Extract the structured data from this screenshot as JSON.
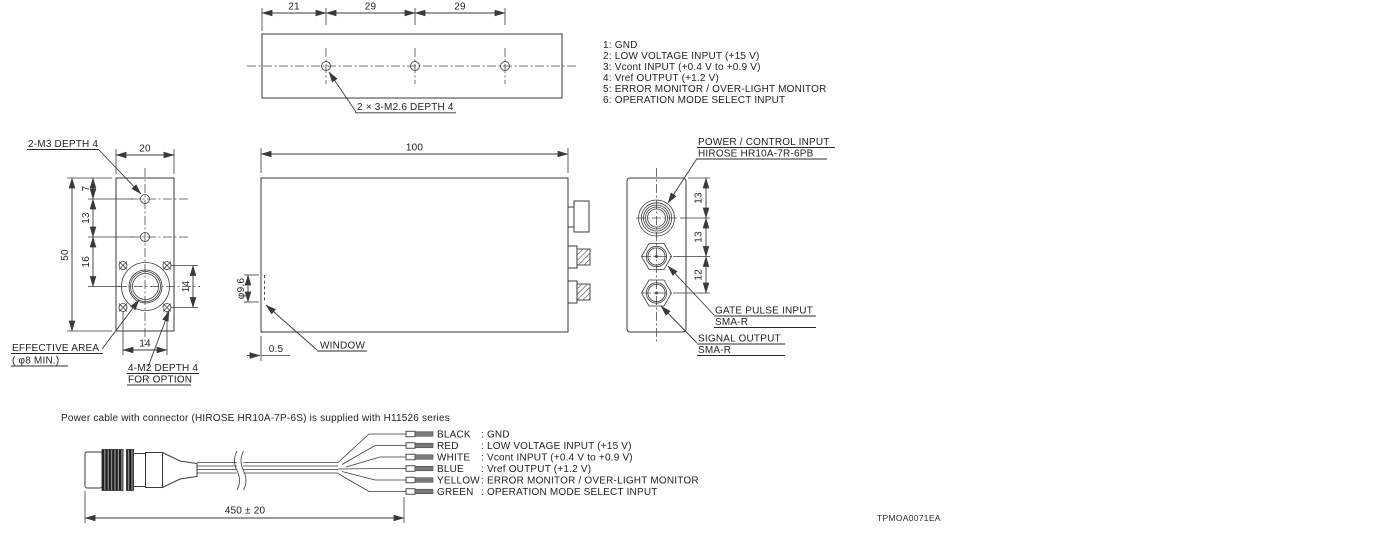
{
  "drawing": {
    "code": "TPMOA0071EA",
    "pin_list": [
      "1: GND",
      "2: LOW VOLTAGE INPUT (+15 V)",
      "3: Vcont INPUT (+0.4 V to +0.9 V)",
      "4: Vref OUTPUT (+1.2 V)",
      "5: ERROR MONITOR / OVER-LIGHT MONITOR",
      "6: OPERATION MODE SELECT INPUT"
    ],
    "top_view": {
      "dim_21": "21",
      "dim_29a": "29",
      "dim_29b": "29",
      "hole_note": "2 × 3-M2.6 DEPTH 4"
    },
    "front_view": {
      "dim_width": "20",
      "dim_height": "50",
      "dim_7": "7",
      "dim_13": "13",
      "dim_16": "16",
      "dim_14_v": "14",
      "dim_14_h": "14",
      "note_m3": "2-M3 DEPTH 4",
      "note_effective_1": "EFFECTIVE AREA",
      "note_effective_2": "( φ8 MIN.)",
      "note_m2_1": "4-M2 DEPTH 4",
      "note_m2_2": "FOR OPTION"
    },
    "side_view": {
      "dim_length": "100",
      "dim_window_dia": "φ9.6",
      "dim_offset": "0.5",
      "note_window": "WINDOW"
    },
    "rear_view": {
      "dim_13a": "13",
      "dim_13b": "13",
      "dim_12": "12",
      "note_power_1": "POWER / CONTROL INPUT",
      "note_power_2": "HIROSE HR10A-7R-6PB",
      "note_gate_1": "GATE PULSE INPUT",
      "note_gate_2": "SMA-R",
      "note_signal_1": "SIGNAL OUTPUT",
      "note_signal_2": "SMA-R"
    },
    "cable": {
      "note": "Power cable with connector (HIROSE HR10A-7P-6S) is supplied with H11526 series",
      "dim_length": "450 ± 20",
      "wires": [
        {
          "color": "BLACK",
          "desc": ": GND"
        },
        {
          "color": "RED",
          "desc": ": LOW VOLTAGE INPUT (+15 V)"
        },
        {
          "color": "WHITE",
          "desc": ": Vcont INPUT (+0.4 V to +0.9 V)"
        },
        {
          "color": "BLUE",
          "desc": ": Vref OUTPUT (+1.2 V)"
        },
        {
          "color": "YELLOW",
          "desc": ": ERROR MONITOR / OVER-LIGHT MONITOR"
        },
        {
          "color": "GREEN",
          "desc": ": OPERATION MODE SELECT INPUT"
        }
      ]
    }
  }
}
